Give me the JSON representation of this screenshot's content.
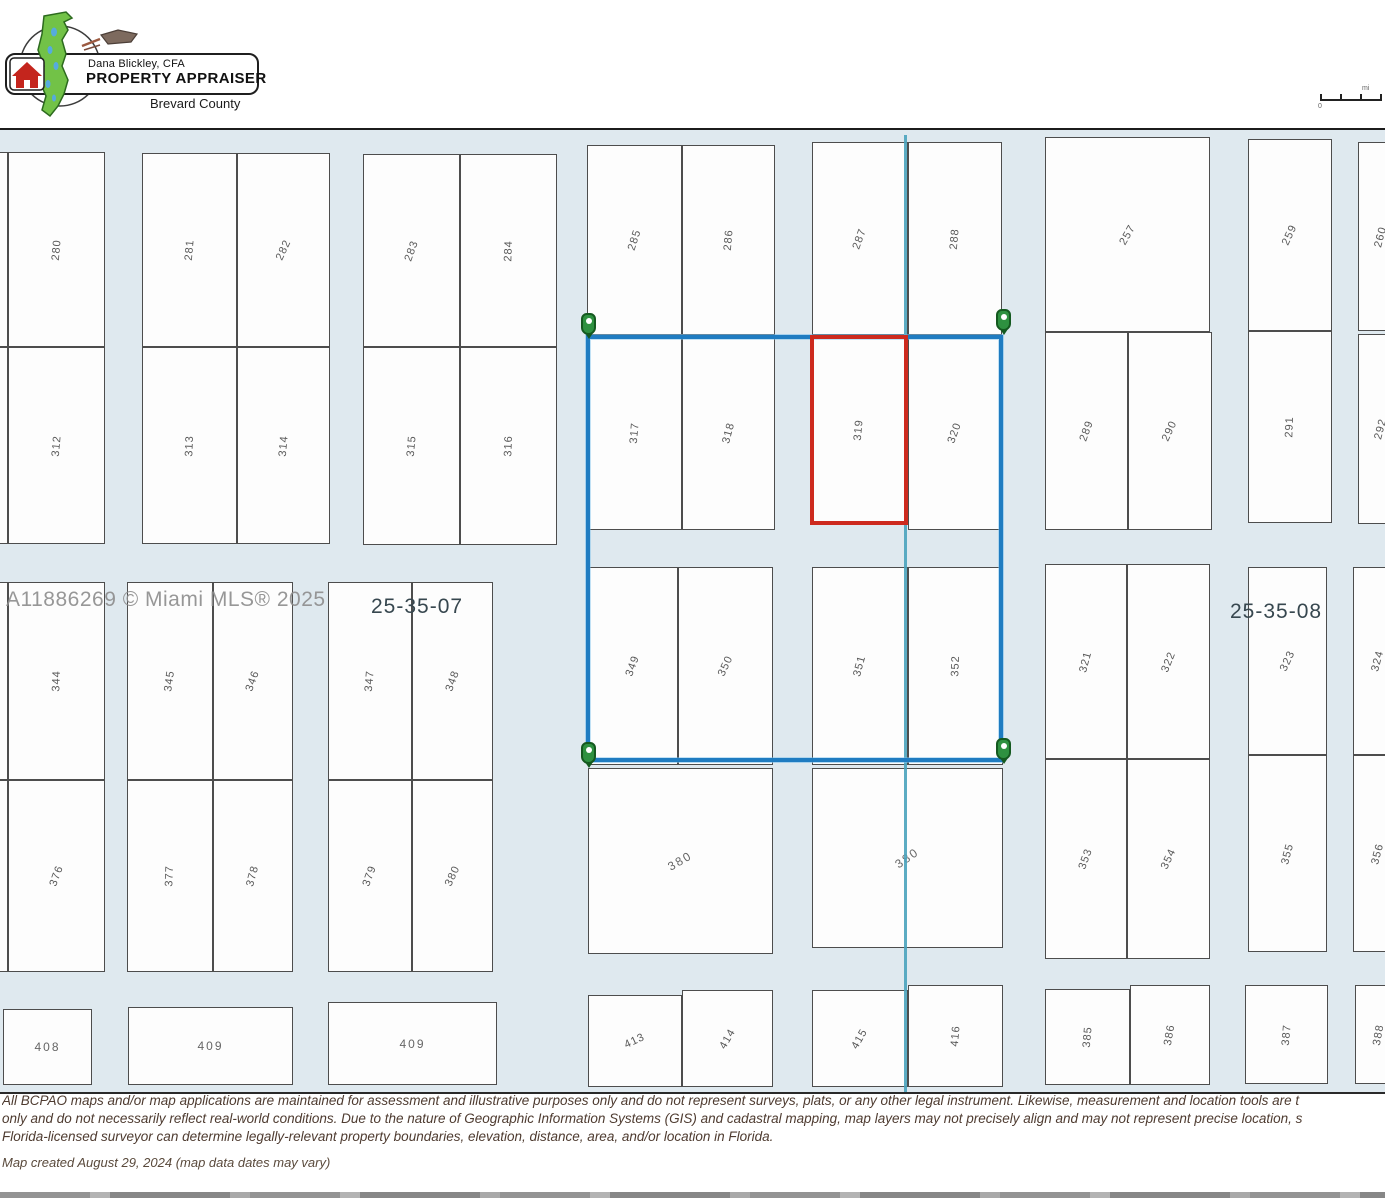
{
  "logo": {
    "name_line": "Dana Blickley, CFA",
    "title_line": "PROPERTY APPRAISER",
    "county_line": "Brevard County"
  },
  "scalebar": {
    "zero_label": "0",
    "unit_label": "mi"
  },
  "watermark": "A11886269 © Miami MLS® 2025",
  "sections": [
    {
      "label": "25-35-07",
      "x": 371,
      "y": 465
    },
    {
      "label": "25-35-08",
      "x": 1230,
      "y": 470
    }
  ],
  "map": {
    "background": "#dfe9ef",
    "selection_color": "#1f7cc1",
    "highlight_color": "#cd2a1e",
    "pin_color": "#2e9140",
    "section_line_color": "#4aa3bd"
  },
  "selection_box": {
    "x": 586,
    "y": 205,
    "w": 417,
    "h": 427
  },
  "highlight_parcel": "319",
  "teal_line": {
    "x": 904,
    "y1": 5,
    "y2": 962
  },
  "pins": [
    {
      "x": 588,
      "y": 205
    },
    {
      "x": 1003,
      "y": 201
    },
    {
      "x": 588,
      "y": 634
    },
    {
      "x": 1003,
      "y": 630
    }
  ],
  "parcels": [
    {
      "label": "",
      "x": -20,
      "y": 22,
      "w": 28,
      "h": 195,
      "rot": -85
    },
    {
      "label": "",
      "x": -20,
      "y": 217,
      "w": 28,
      "h": 197,
      "rot": -85
    },
    {
      "label": "",
      "x": -20,
      "y": 452,
      "w": 28,
      "h": 198,
      "rot": -85
    },
    {
      "label": "",
      "x": -20,
      "y": 650,
      "w": 28,
      "h": 192,
      "rot": -85
    },
    {
      "label": "",
      "x": -20,
      "y": 879,
      "w": 20,
      "h": 75,
      "rot": 0
    },
    {
      "label": "280",
      "x": 8,
      "y": 22,
      "w": 97,
      "h": 195,
      "rot": -85
    },
    {
      "label": "312",
      "x": 8,
      "y": 217,
      "w": 97,
      "h": 197,
      "rot": -85
    },
    {
      "label": "344",
      "x": 8,
      "y": 452,
      "w": 97,
      "h": 198,
      "rot": -88
    },
    {
      "label": "376",
      "x": 8,
      "y": 650,
      "w": 97,
      "h": 192,
      "rot": -70
    },
    {
      "label": "408",
      "x": 3,
      "y": 879,
      "w": 89,
      "h": 76,
      "rot": 0,
      "flat": true
    },
    {
      "label": "281",
      "x": 142,
      "y": 23,
      "w": 95,
      "h": 194,
      "rot": -85
    },
    {
      "label": "282",
      "x": 237,
      "y": 23,
      "w": 93,
      "h": 194,
      "rot": -65
    },
    {
      "label": "313",
      "x": 142,
      "y": 217,
      "w": 95,
      "h": 197,
      "rot": -88
    },
    {
      "label": "314",
      "x": 237,
      "y": 217,
      "w": 93,
      "h": 197,
      "rot": -85
    },
    {
      "label": "345",
      "x": 127,
      "y": 452,
      "w": 86,
      "h": 198,
      "rot": -82
    },
    {
      "label": "346",
      "x": 213,
      "y": 452,
      "w": 80,
      "h": 198,
      "rot": -70
    },
    {
      "label": "377",
      "x": 127,
      "y": 650,
      "w": 86,
      "h": 192,
      "rot": -88
    },
    {
      "label": "378",
      "x": 213,
      "y": 650,
      "w": 80,
      "h": 192,
      "rot": -75
    },
    {
      "label": "409",
      "x": 128,
      "y": 877,
      "w": 165,
      "h": 78,
      "rot": 0,
      "flat": true
    },
    {
      "label": "283",
      "x": 363,
      "y": 24,
      "w": 97,
      "h": 193,
      "rot": -70
    },
    {
      "label": "284",
      "x": 460,
      "y": 24,
      "w": 97,
      "h": 193,
      "rot": -88
    },
    {
      "label": "315",
      "x": 363,
      "y": 217,
      "w": 97,
      "h": 198,
      "rot": -85
    },
    {
      "label": "316",
      "x": 460,
      "y": 217,
      "w": 97,
      "h": 198,
      "rot": -88
    },
    {
      "label": "347",
      "x": 328,
      "y": 452,
      "w": 84,
      "h": 198,
      "rot": -85
    },
    {
      "label": "348",
      "x": 412,
      "y": 452,
      "w": 81,
      "h": 198,
      "rot": -70
    },
    {
      "label": "379",
      "x": 328,
      "y": 650,
      "w": 84,
      "h": 192,
      "rot": -70
    },
    {
      "label": "380",
      "x": 412,
      "y": 650,
      "w": 81,
      "h": 192,
      "rot": -65
    },
    {
      "label": "409",
      "x": 328,
      "y": 872,
      "w": 169,
      "h": 83,
      "rot": 0,
      "flat": true
    },
    {
      "label": "285",
      "x": 587,
      "y": 15,
      "w": 95,
      "h": 190,
      "rot": -72
    },
    {
      "label": "286",
      "x": 682,
      "y": 15,
      "w": 93,
      "h": 190,
      "rot": -85
    },
    {
      "label": "317",
      "x": 587,
      "y": 205,
      "w": 95,
      "h": 195,
      "rot": -85
    },
    {
      "label": "318",
      "x": 682,
      "y": 205,
      "w": 93,
      "h": 195,
      "rot": -75
    },
    {
      "label": "349",
      "x": 588,
      "y": 437,
      "w": 90,
      "h": 198,
      "rot": -70
    },
    {
      "label": "350",
      "x": 678,
      "y": 437,
      "w": 95,
      "h": 198,
      "rot": -65
    },
    {
      "label": "380",
      "x": 588,
      "y": 638,
      "w": 185,
      "h": 186,
      "rot": -30,
      "flat": true
    },
    {
      "label": "413",
      "x": 588,
      "y": 865,
      "w": 94,
      "h": 92,
      "rot": -25
    },
    {
      "label": "414",
      "x": 682,
      "y": 860,
      "w": 91,
      "h": 97,
      "rot": -60
    },
    {
      "label": "287",
      "x": 812,
      "y": 12,
      "w": 96,
      "h": 193,
      "rot": -70
    },
    {
      "label": "288",
      "x": 908,
      "y": 12,
      "w": 94,
      "h": 193,
      "rot": -85
    },
    {
      "label": "319",
      "x": 810,
      "y": 205,
      "w": 98,
      "h": 190,
      "rot": -85,
      "type": "highlight"
    },
    {
      "label": "320",
      "x": 908,
      "y": 205,
      "w": 94,
      "h": 195,
      "rot": -70
    },
    {
      "label": "351",
      "x": 812,
      "y": 437,
      "w": 96,
      "h": 198,
      "rot": -75
    },
    {
      "label": "352",
      "x": 908,
      "y": 437,
      "w": 95,
      "h": 198,
      "rot": -88
    },
    {
      "label": "380",
      "x": 812,
      "y": 638,
      "w": 191,
      "h": 180,
      "rot": -35,
      "flat": true
    },
    {
      "label": "415",
      "x": 812,
      "y": 860,
      "w": 96,
      "h": 97,
      "rot": -60
    },
    {
      "label": "416",
      "x": 908,
      "y": 855,
      "w": 95,
      "h": 102,
      "rot": -85
    },
    {
      "label": "257",
      "x": 1045,
      "y": 7,
      "w": 165,
      "h": 195,
      "rot": -60
    },
    {
      "label": "289",
      "x": 1045,
      "y": 202,
      "w": 83,
      "h": 198,
      "rot": -70
    },
    {
      "label": "290",
      "x": 1128,
      "y": 202,
      "w": 84,
      "h": 198,
      "rot": -65
    },
    {
      "label": "321",
      "x": 1045,
      "y": 434,
      "w": 82,
      "h": 195,
      "rot": -75
    },
    {
      "label": "322",
      "x": 1127,
      "y": 434,
      "w": 83,
      "h": 195,
      "rot": -68
    },
    {
      "label": "353",
      "x": 1045,
      "y": 629,
      "w": 82,
      "h": 200,
      "rot": -70
    },
    {
      "label": "354",
      "x": 1127,
      "y": 629,
      "w": 83,
      "h": 200,
      "rot": -65
    },
    {
      "label": "385",
      "x": 1045,
      "y": 859,
      "w": 85,
      "h": 96,
      "rot": -85
    },
    {
      "label": "386",
      "x": 1130,
      "y": 855,
      "w": 80,
      "h": 100,
      "rot": -80
    },
    {
      "label": "259",
      "x": 1248,
      "y": 9,
      "w": 84,
      "h": 192,
      "rot": -65
    },
    {
      "label": "291",
      "x": 1248,
      "y": 201,
      "w": 84,
      "h": 192,
      "rot": -88
    },
    {
      "label": "323",
      "x": 1248,
      "y": 437,
      "w": 79,
      "h": 188,
      "rot": -65
    },
    {
      "label": "355",
      "x": 1248,
      "y": 625,
      "w": 79,
      "h": 197,
      "rot": -75
    },
    {
      "label": "387",
      "x": 1245,
      "y": 855,
      "w": 83,
      "h": 99,
      "rot": -85
    },
    {
      "label": "260",
      "x": 1358,
      "y": 12,
      "w": 46,
      "h": 189,
      "rot": -75
    },
    {
      "label": "292",
      "x": 1358,
      "y": 204,
      "w": 46,
      "h": 190,
      "rot": -75
    },
    {
      "label": "324",
      "x": 1353,
      "y": 437,
      "w": 50,
      "h": 188,
      "rot": -75
    },
    {
      "label": "356",
      "x": 1353,
      "y": 625,
      "w": 50,
      "h": 197,
      "rot": -75
    },
    {
      "label": "388",
      "x": 1355,
      "y": 855,
      "w": 48,
      "h": 99,
      "rot": -80
    }
  ],
  "disclaimer": {
    "line1": "All BCPAO maps and/or map applications are maintained for assessment and illustrative purposes only and do not represent surveys, plats, or any other legal instrument. Likewise, measurement and location tools are t",
    "line2": "only and do not necessarily reflect real-world conditions. Due to the nature of Geographic Information Systems (GIS) and cadastral mapping, map layers may not precisely align and may not represent precise location, s",
    "line3": "Florida-licensed surveyor can determine legally-relevant property boundaries, elevation, distance, area, and/or location in Florida."
  },
  "created": "Map created August 29, 2024 (map data dates may vary)"
}
